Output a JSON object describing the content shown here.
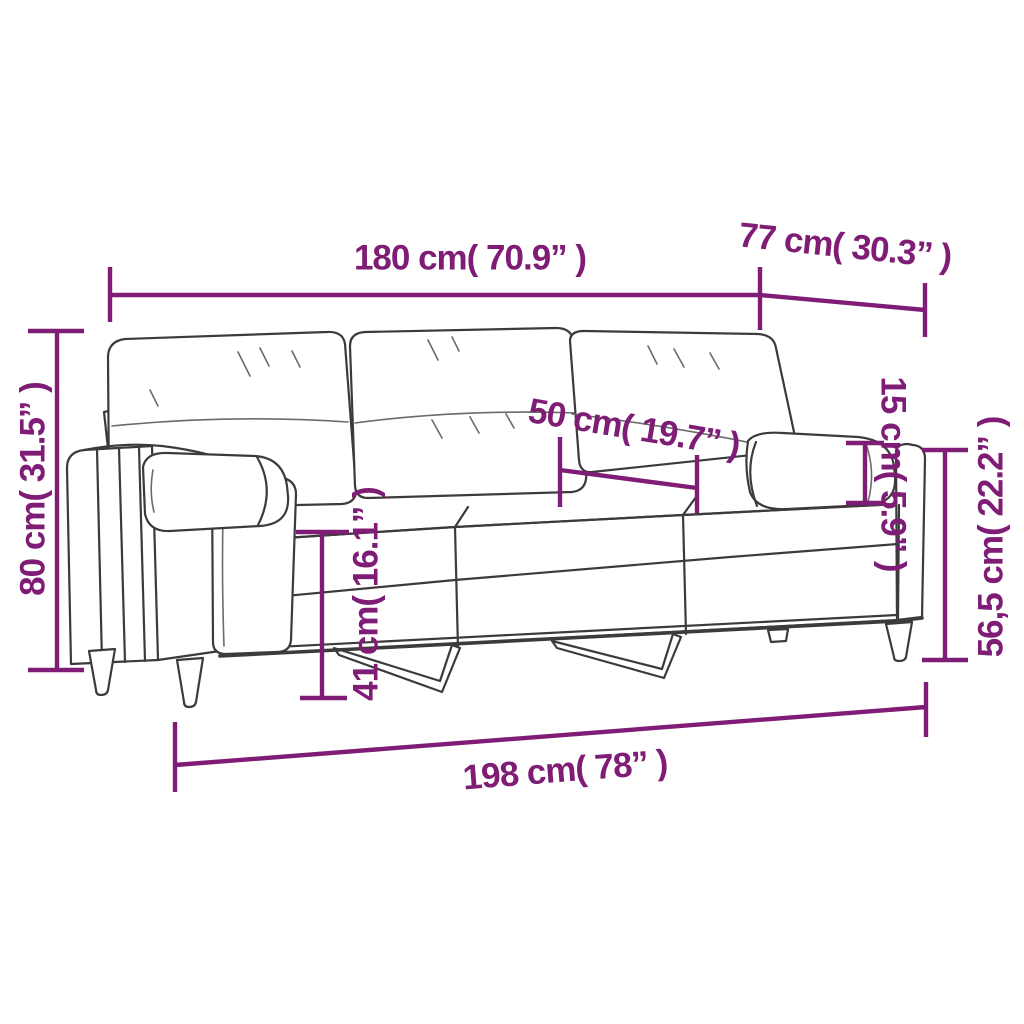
{
  "diagram": {
    "title": "3-seater sofa with bolster and back cushions — dimension diagram",
    "illustration": "three-seater-sofa-line-drawing",
    "colors": {
      "dimension_annotation": "#7F1C75",
      "line_art": "#3D3A3C",
      "background": "#FFFFFF"
    },
    "dimensions": [
      {
        "id": "backrest-width",
        "label": "180 cm( 70.9” )"
      },
      {
        "id": "depth",
        "label": "77 cm( 30.3” )"
      },
      {
        "id": "back-height",
        "label": "80 cm( 31.5” )"
      },
      {
        "id": "seat-depth",
        "label": "50 cm( 19.7” )"
      },
      {
        "id": "seat-height",
        "label": "41 cm( 16.1” )"
      },
      {
        "id": "bolster-pillow-height",
        "label": "15 cm( 5.9” )"
      },
      {
        "id": "armrest-height",
        "label": "56,5 cm( 22.2” )"
      },
      {
        "id": "total-width",
        "label": "198 cm( 78” )"
      }
    ]
  }
}
